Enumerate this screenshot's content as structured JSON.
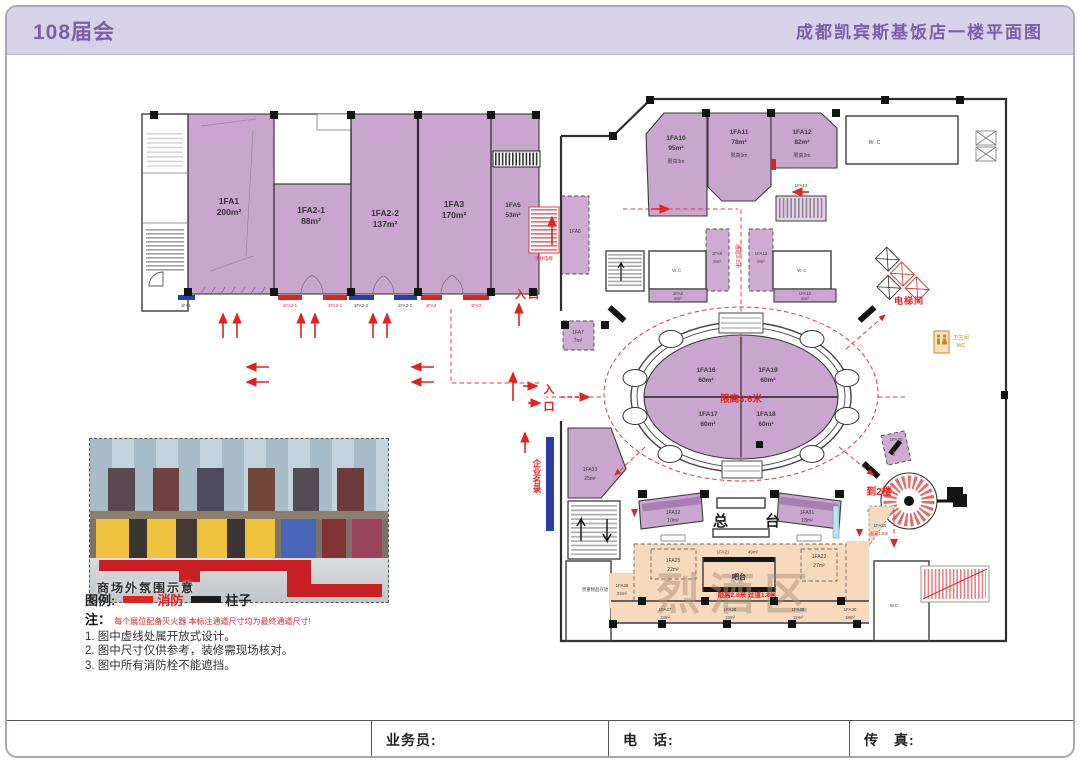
{
  "header": {
    "left_title": "108届会",
    "right_title": "成都凯宾斯基饭店一楼平面图"
  },
  "plan": {
    "rooms": {
      "fa1": {
        "id": "1FA1",
        "area": "200m²"
      },
      "fa2_1": {
        "id": "1FA2-1",
        "area": "88m²"
      },
      "fa2_2": {
        "id": "1FA2-2",
        "area": "137m²"
      },
      "fa3": {
        "id": "1FA3",
        "area": "170m²"
      },
      "fa5": {
        "id": "1FA5",
        "area": "53m²"
      },
      "fa6": {
        "id": "1FA6"
      },
      "fa7": {
        "id": "1FA7",
        "area": "7m²"
      },
      "fa8": {
        "id": "1FA8",
        "area": "8m²"
      },
      "fa9": {
        "id": "1FA9",
        "area": "8m²"
      },
      "fa10": {
        "id": "1FA10",
        "area": "95m²",
        "note": "限高3m"
      },
      "fa11": {
        "id": "1FA11",
        "area": "78m²",
        "note": "限高3m"
      },
      "fa12": {
        "id": "1FA12",
        "area": "82m²",
        "note": "限高3m"
      },
      "fa13": {
        "id": "1FA13",
        "area": "8m²"
      },
      "fa14": {
        "id": "1FA14"
      },
      "fa15": {
        "id": "1FA15",
        "area": "8m²"
      },
      "fa16": {
        "id": "1FA16",
        "area": "60m²"
      },
      "fa17": {
        "id": "1FA17",
        "area": "60m²"
      },
      "fa18": {
        "id": "1FA18",
        "area": "60m²"
      },
      "fa19": {
        "id": "1FA19",
        "area": "60m²"
      },
      "fa20": {
        "id": "1FA20"
      },
      "fa21": {
        "id": "1FA21",
        "area": "49m²"
      },
      "fa22": {
        "id": "1FA22",
        "area": "27m²"
      },
      "fa25": {
        "id": "1FA25",
        "area": "22m²"
      },
      "fa26": {
        "id": "1FA26",
        "area": "23m²"
      },
      "fa27": {
        "id": "1FA27",
        "area": "13m²"
      },
      "fa28": {
        "id": "1FA28",
        "area": "13m²"
      },
      "fa29": {
        "id": "1FA29",
        "area": "11m²"
      },
      "fa30": {
        "id": "1FA30",
        "area": "18m²",
        "note": "限高1.8米"
      },
      "fa31": {
        "id": "1FA31",
        "area": "18m²"
      },
      "fa32": {
        "id": "1FA32",
        "area": "10m²"
      },
      "fa33": {
        "id": "1FA33",
        "area": "25m²"
      }
    },
    "labels": {
      "entrance": "入口",
      "entrance_char1": "入",
      "entrance_char2": "口",
      "escalator": "手扶电梯",
      "elevator_hall": "电梯间",
      "corridor_note": "通道3.5米",
      "front_desk": "总台",
      "bar_counter": "吧台",
      "to_2f": "到2楼",
      "company_directory": "企业名录",
      "valuables": "贵重物品存放",
      "spirits_zone": "烈酒区",
      "oval_height_note": "限高3.6米",
      "bar_height_note": "限高2.8米 过道1.8米",
      "wc": "W.C",
      "restroom": "卫生间",
      "restroom_wc": "WC"
    },
    "storefront_labels": [
      "1FA1",
      "1FA2-1",
      "1FA2-1",
      "1FA2-2",
      "1FA2-2",
      "1FA3",
      "1FA3"
    ]
  },
  "inset": {
    "caption": "商场外氛围示意"
  },
  "legend": {
    "title": "图例:",
    "fire": "消防",
    "column": "柱子"
  },
  "notes": {
    "prefix": "注：",
    "warning": "每个展位配备灭火器 本标注通道尺寸均为最终通道尺寸!",
    "item1": "1. 图中虚线处属开放式设计。",
    "item2": "2. 图中尺寸仅供参考，装修需现场核对。",
    "item3": "3. 图中所有消防栓不能遮挡。"
  },
  "footer": {
    "salesperson": "业务员:",
    "phone": "电　话:",
    "fax": "传　真:"
  }
}
